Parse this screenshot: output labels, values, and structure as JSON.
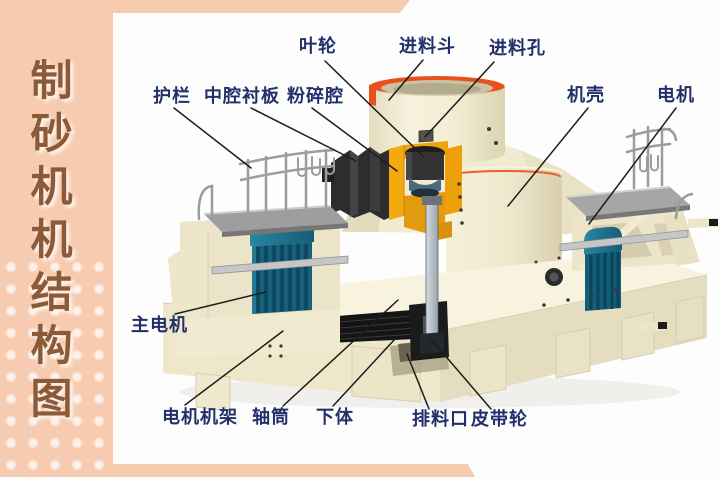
{
  "page": {
    "background_color": "#fdfdfe",
    "accent_pink": "#f6cbb0"
  },
  "sidebar": {
    "title": "制砂机机结构图",
    "text_color": "#8a5a39"
  },
  "diagram": {
    "label_color": "#22306a",
    "labels": {
      "impeller": "叶轮",
      "feed_hopper": "进料斗",
      "feed_hole": "进料孔",
      "guardrail": "护栏",
      "cavity_liner": "中腔衬板",
      "crushing_chamber": "粉碎腔",
      "casing": "机壳",
      "motor": "电机",
      "main_motor": "主电机",
      "motor_frame": "电机机架",
      "shaft_tube": "轴筒",
      "lower_body": "下体",
      "discharge_port": "排料口",
      "belt_pulley": "皮带轮"
    },
    "machine_colors": {
      "body_cream": "#f2ecd2",
      "hopper_rim_red": "#e8511c",
      "chamber_orange": "#f2a60f",
      "motor_teal": "#1d7492",
      "deck_gray": "#a3a3a3",
      "dark_parts": "#222222",
      "shaft_gray": "#9aa4ac"
    }
  }
}
